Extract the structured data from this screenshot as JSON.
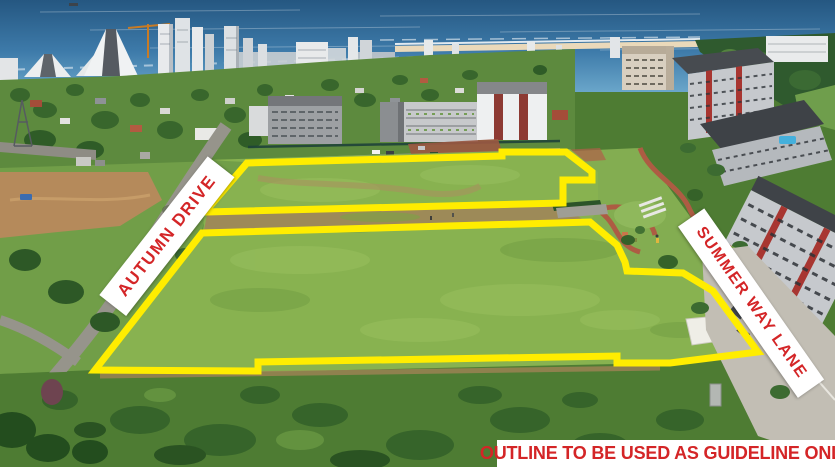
{
  "canvas": {
    "width": 835,
    "height": 467
  },
  "annotations": {
    "street_left": {
      "label": "AUTUMN DRIVE"
    },
    "street_right": {
      "label": "SUMMER WAY LANE"
    },
    "disclaimer": {
      "label": "OUTLINE TO BE USED AS GUIDELINE ONLY"
    }
  },
  "colors": {
    "annotation_red": "#d42527",
    "label_background": "#ffffff",
    "outline_yellow": "#ffed00",
    "ocean_deep": "#255781",
    "ocean_light": "#6aa6ca",
    "field_green": "#88b250",
    "scrub_green": "#4e7c33"
  },
  "outline": {
    "stroke_width": 7,
    "parcels": [
      {
        "name": "upper-parcel",
        "points": [
          [
            247,
            163
          ],
          [
            502,
            156
          ],
          [
            502,
            152
          ],
          [
            566,
            152
          ],
          [
            592,
            172
          ],
          [
            592,
            180
          ],
          [
            563,
            180
          ],
          [
            563,
            203
          ],
          [
            205,
            212
          ]
        ]
      },
      {
        "name": "lower-parcel",
        "points": [
          [
            202,
            233
          ],
          [
            590,
            222
          ],
          [
            617,
            245
          ],
          [
            625,
            262
          ],
          [
            627,
            271
          ],
          [
            683,
            273
          ],
          [
            713,
            291
          ],
          [
            758,
            352
          ],
          [
            670,
            363
          ],
          [
            617,
            363
          ],
          [
            617,
            356
          ],
          [
            258,
            362
          ],
          [
            258,
            371
          ],
          [
            95,
            370
          ]
        ]
      }
    ]
  }
}
